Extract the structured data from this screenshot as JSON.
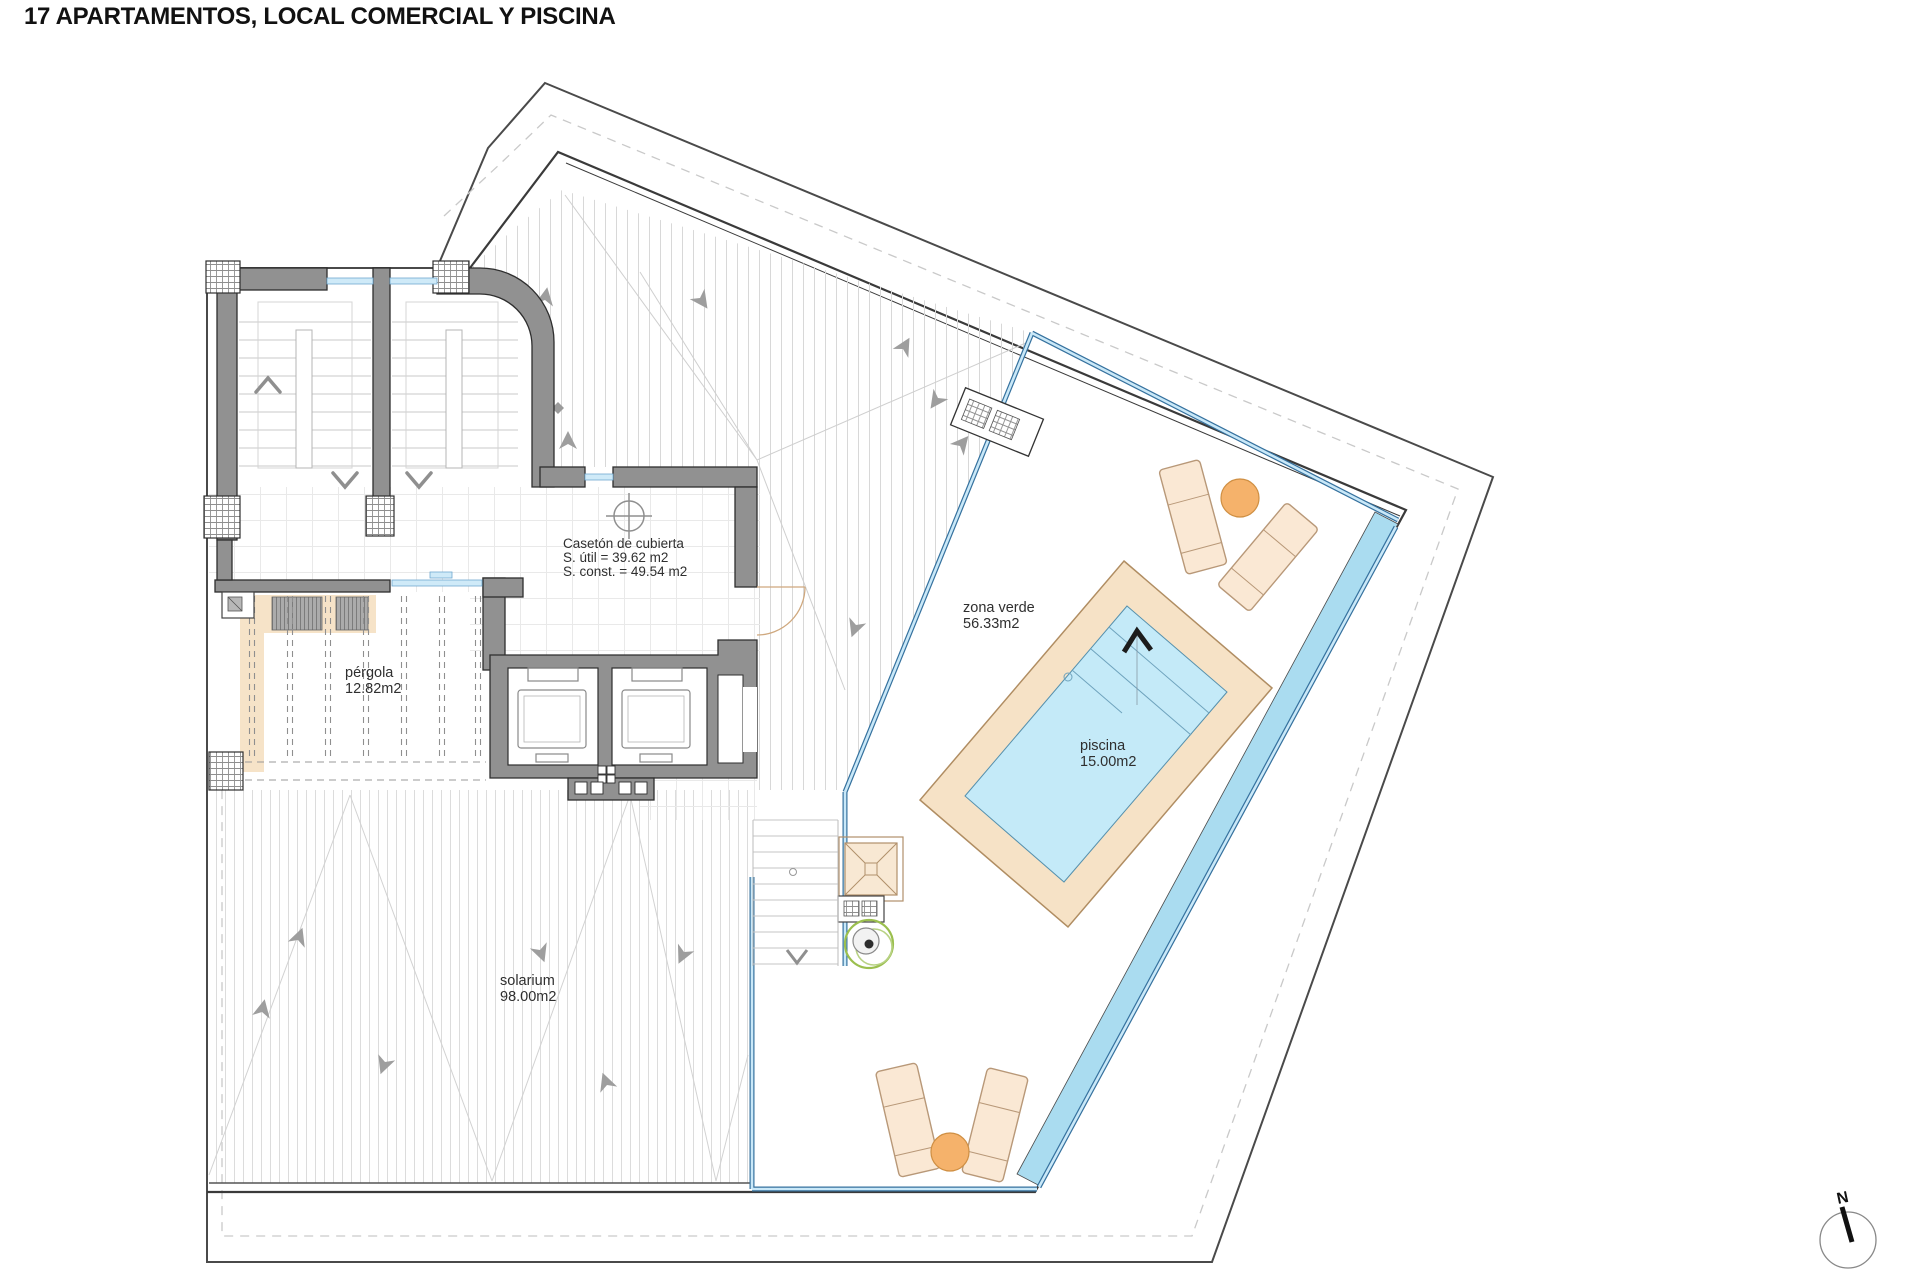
{
  "title": "17 APARTAMENTOS, LOCAL COMERCIAL Y PISCINA",
  "labels": {
    "caseton": {
      "l1": "Casetón de cubierta",
      "l2": "S. útil = 39.62 m2",
      "l3": "S. const. = 49.54 m2"
    },
    "zona_verde": {
      "name": "zona verde",
      "area": "56.33m2"
    },
    "piscina": {
      "name": "piscina",
      "area": "15.00m2"
    },
    "pergola": {
      "name": "pérgola",
      "area": "12.82m2"
    },
    "solarium": {
      "name": "solarium",
      "area": "98.00m2"
    }
  },
  "compass": {
    "letter": "N"
  },
  "colors": {
    "wall_grey": "#919191",
    "pool_water": "#c4eaf8",
    "water_channel": "#aadcf0",
    "glass_blue_dark": "#35719e",
    "glass_blue_light": "#c9e8f8",
    "deck_tan": "#f6e2c6",
    "lounger_tan": "#fae8d4",
    "table_orange": "#f5b26b",
    "plant_green": "#9bbf4e",
    "hatch_grey": "#d8d8d8"
  }
}
